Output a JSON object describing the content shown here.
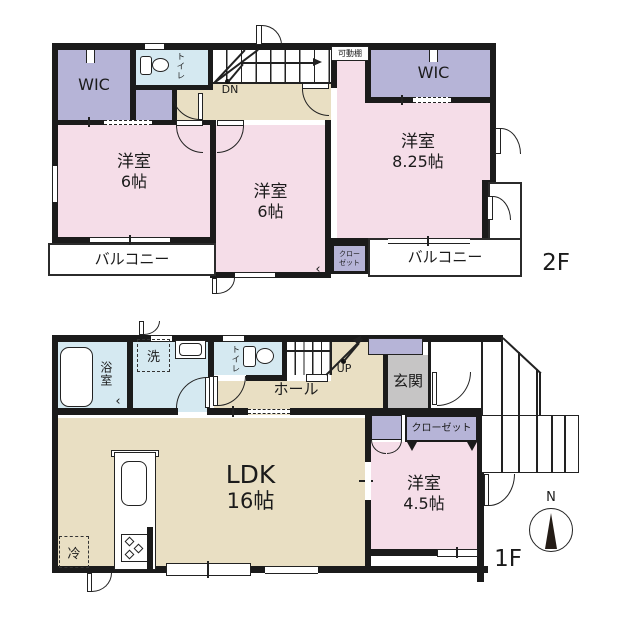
{
  "floor2": {
    "label": "2F",
    "wic_left": "WIC",
    "wic_right": "WIC",
    "toilet": "トイレ",
    "stairs_label": "DN",
    "movable_shelf": "可動棚",
    "room_left": {
      "name": "洋室",
      "size": "6帖"
    },
    "room_mid": {
      "name": "洋室",
      "size": "6帖"
    },
    "room_right": {
      "name": "洋室",
      "size": "8.25帖"
    },
    "balcony_left": "バルコニー",
    "balcony_right": "バルコニー",
    "closet_line1": "クロー",
    "closet_line2": "ゼット",
    "closet_fold_mark": "‹"
  },
  "floor1": {
    "label": "1F",
    "bath": "浴室",
    "bath_fold_mark": "‹",
    "washer": "洗",
    "toilet": "トイレ",
    "stairs_label": "UP",
    "hall": "ホール",
    "entrance": "玄関",
    "closet": "クローゼット",
    "ldk": {
      "name": "LDK",
      "size": "16帖"
    },
    "room": {
      "name": "洋室",
      "size": "4.5帖"
    },
    "fridge": "冷",
    "compass_north": "N"
  },
  "colors": {
    "wall": "#1b1b1b",
    "room_pink": "#f5dde8",
    "closet_purple": "#b6b4d7",
    "water_blue": "#d5e9f1",
    "floor_tan": "#e9dfc3",
    "entrance_gray": "#c6c5c5"
  }
}
